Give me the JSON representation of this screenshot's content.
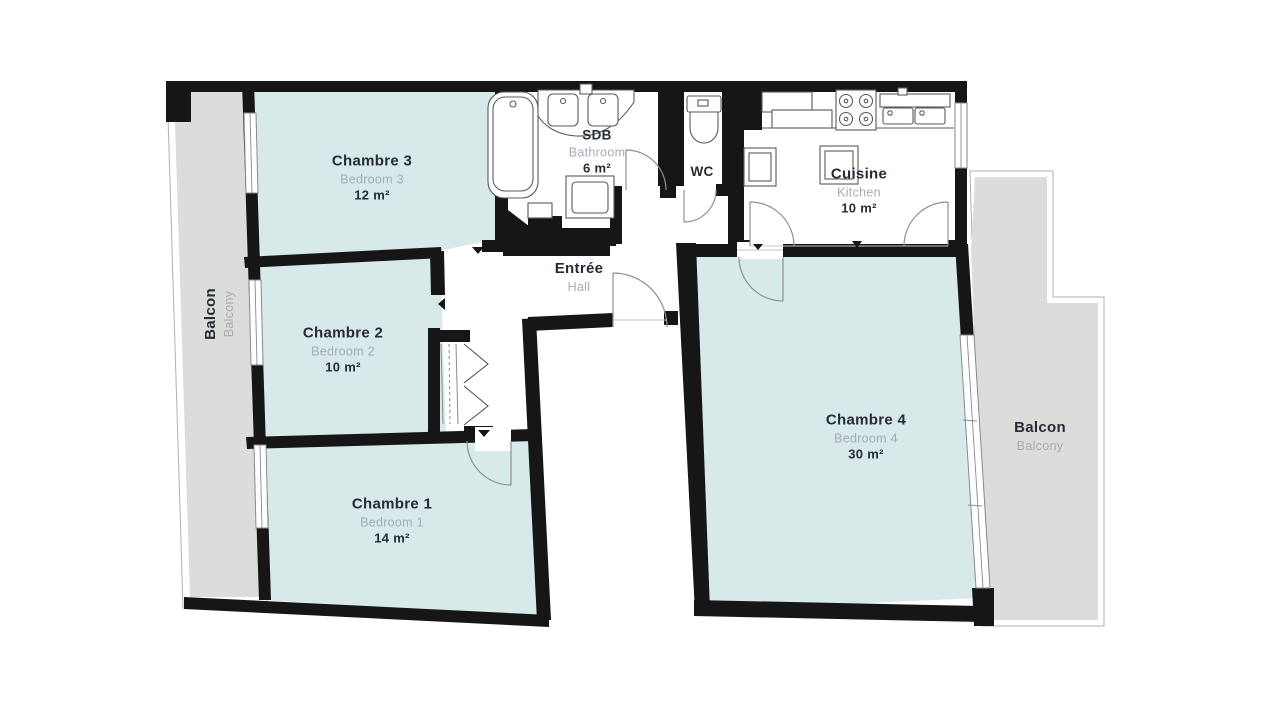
{
  "colors": {
    "wall": "#161616",
    "room_fill": "#d7e9e9",
    "balcony_fill": "#dcdcda",
    "outline": "#b0b0b0",
    "window_line": "#8a8a8a",
    "fixture": "#5a5a5a",
    "door": "#8f8f8f",
    "text_dark": "#262b36",
    "text_gray": "#a6abb3"
  },
  "rooms": {
    "bedroom3": {
      "name": "Chambre 3",
      "sub": "Bedroom 3",
      "area": "12 m²"
    },
    "bedroom2": {
      "name": "Chambre 2",
      "sub": "Bedroom 2",
      "area": "10 m²"
    },
    "bedroom1": {
      "name": "Chambre 1",
      "sub": "Bedroom 1",
      "area": "14 m²"
    },
    "bedroom4": {
      "name": "Chambre 4",
      "sub": "Bedroom 4",
      "area": "30 m²"
    },
    "bathroom": {
      "name": "SDB",
      "sub": "Bathroom",
      "area": "6 m²"
    },
    "wc": {
      "name": "WC"
    },
    "kitchen": {
      "name": "Cuisine",
      "sub": "Kitchen",
      "area": "10 m²"
    },
    "hall": {
      "name": "Entrée",
      "sub": "Hall"
    },
    "balcony_left": {
      "name": "Balcon",
      "sub": "Balcony"
    },
    "balcony_right": {
      "name": "Balcon",
      "sub": "Balcony"
    }
  }
}
